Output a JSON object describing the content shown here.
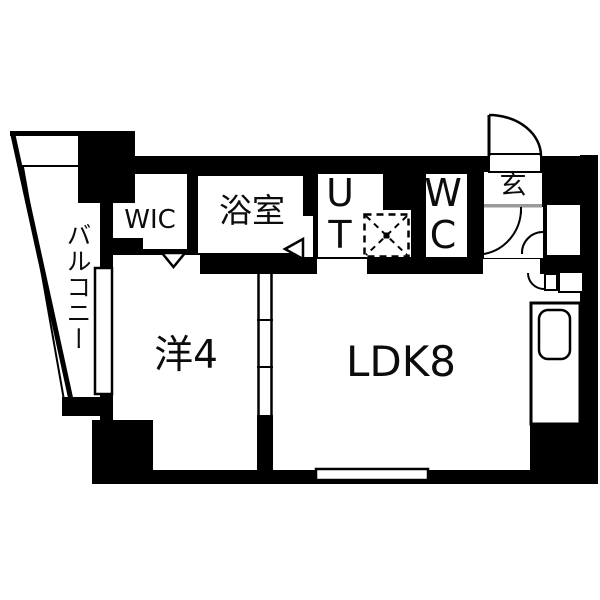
{
  "colors": {
    "ink": "#000000",
    "bg": "#ffffff",
    "step_line": "#9a9a9a"
  },
  "plan": {
    "balcony_label": "バルコニー",
    "wic_label": "WIC",
    "bathroom_label": "浴室",
    "utility_label": "U\nT",
    "wc_label": "W\nC",
    "entrance_label": "玄",
    "western_room_label": "洋4",
    "ldk_label": "LDK8"
  },
  "fixtures": [
    "entrance-door-swing",
    "closet-double-door-swing",
    "interior-door-swing",
    "washing-machine-pan",
    "kitchen-counter",
    "kitchen-sink",
    "wic-folding-door-marker",
    "bathroom-door-marker",
    "sliding-door-track",
    "balcony-window",
    "ldk-window"
  ]
}
